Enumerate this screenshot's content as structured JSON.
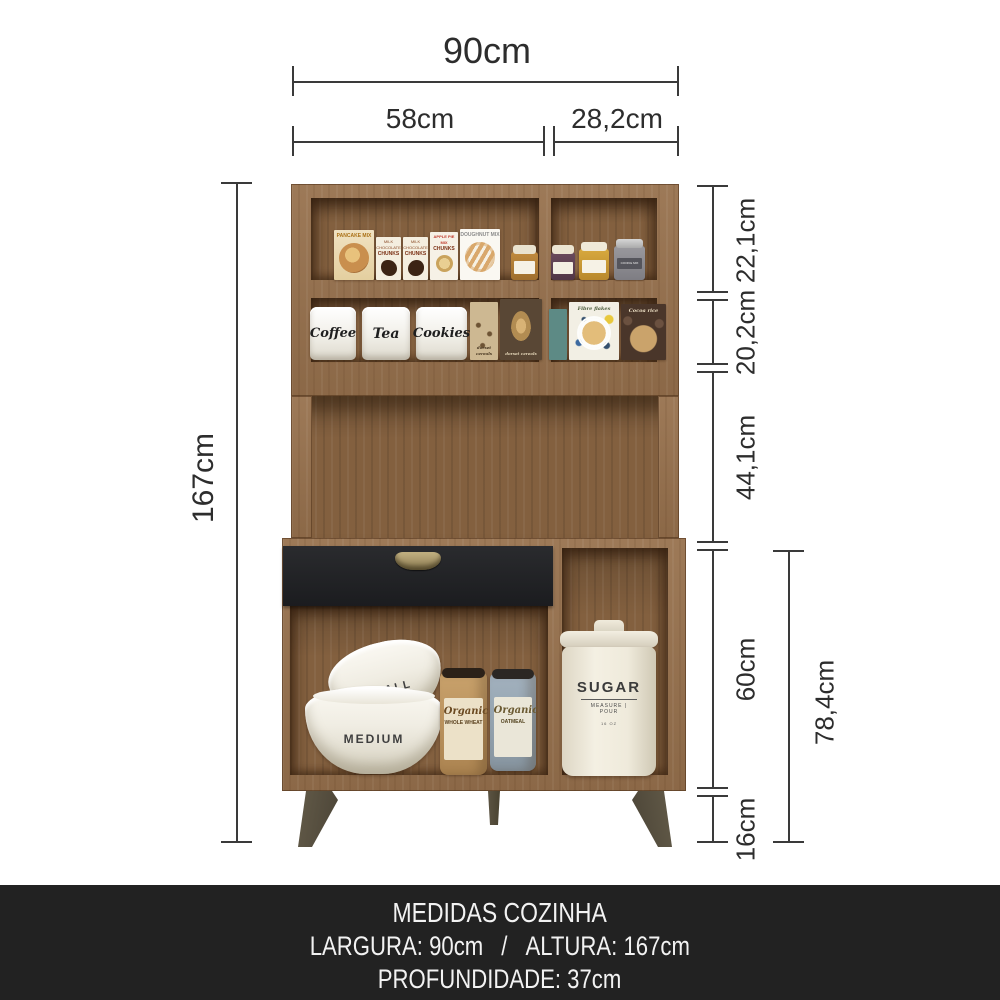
{
  "dims": {
    "top_total": "90cm",
    "top_left": "58cm",
    "top_right": "28,2cm",
    "left_total": "167cm",
    "seg_top_shelf": "22,1cm",
    "seg_mid_shelf": "20,2cm",
    "seg_open": "44,1cm",
    "seg_base": "60cm",
    "seg_feet": "16cm",
    "seg_base_total": "78,4cm"
  },
  "footer": {
    "title": "MEDIDAS COZINHA",
    "largura": "LARGURA: 90cm",
    "sep": "/",
    "altura": "ALTURA: 167cm",
    "profundidade": "PROFUNDIDADE: 37cm",
    "bg_color": "#222222",
    "text_color": "#f2f2f2"
  },
  "products": {
    "pancake_mix": "PANCAKE MIX",
    "milk_chocolate": "MILK CHOCOLATE",
    "chunks": "CHUNKS",
    "apple_pie_mix": "APPLE PIE MIX",
    "doughnut_mix": "DOUGHNUT MIX",
    "cookie_mix_jar": "COOKIE MIX",
    "coffee": "Coffee",
    "tea": "Tea",
    "cookies": "Cookies",
    "dorset": "dorset cereals",
    "fibre_flakes": "Fibre flakes",
    "cocoa_rice": "Cocoa rice",
    "small_bowl": "SMALL",
    "medium_bowl": "MEDIUM",
    "organic": "Organic",
    "whole_wheat": "WHOLE WHEAT",
    "oatmeal": "OATMEAL",
    "sugar": "SUGAR",
    "sugar_sub": "MEASURE | POUR",
    "sugar_oz": "16 OZ"
  },
  "colors": {
    "wood_frame": "#97714d",
    "wood_back": "#83603f",
    "drawer_front": "#1f2023",
    "drawer_handle": "#988655",
    "legs": "#57503f",
    "dimension_lines": "#3a3a3a"
  }
}
